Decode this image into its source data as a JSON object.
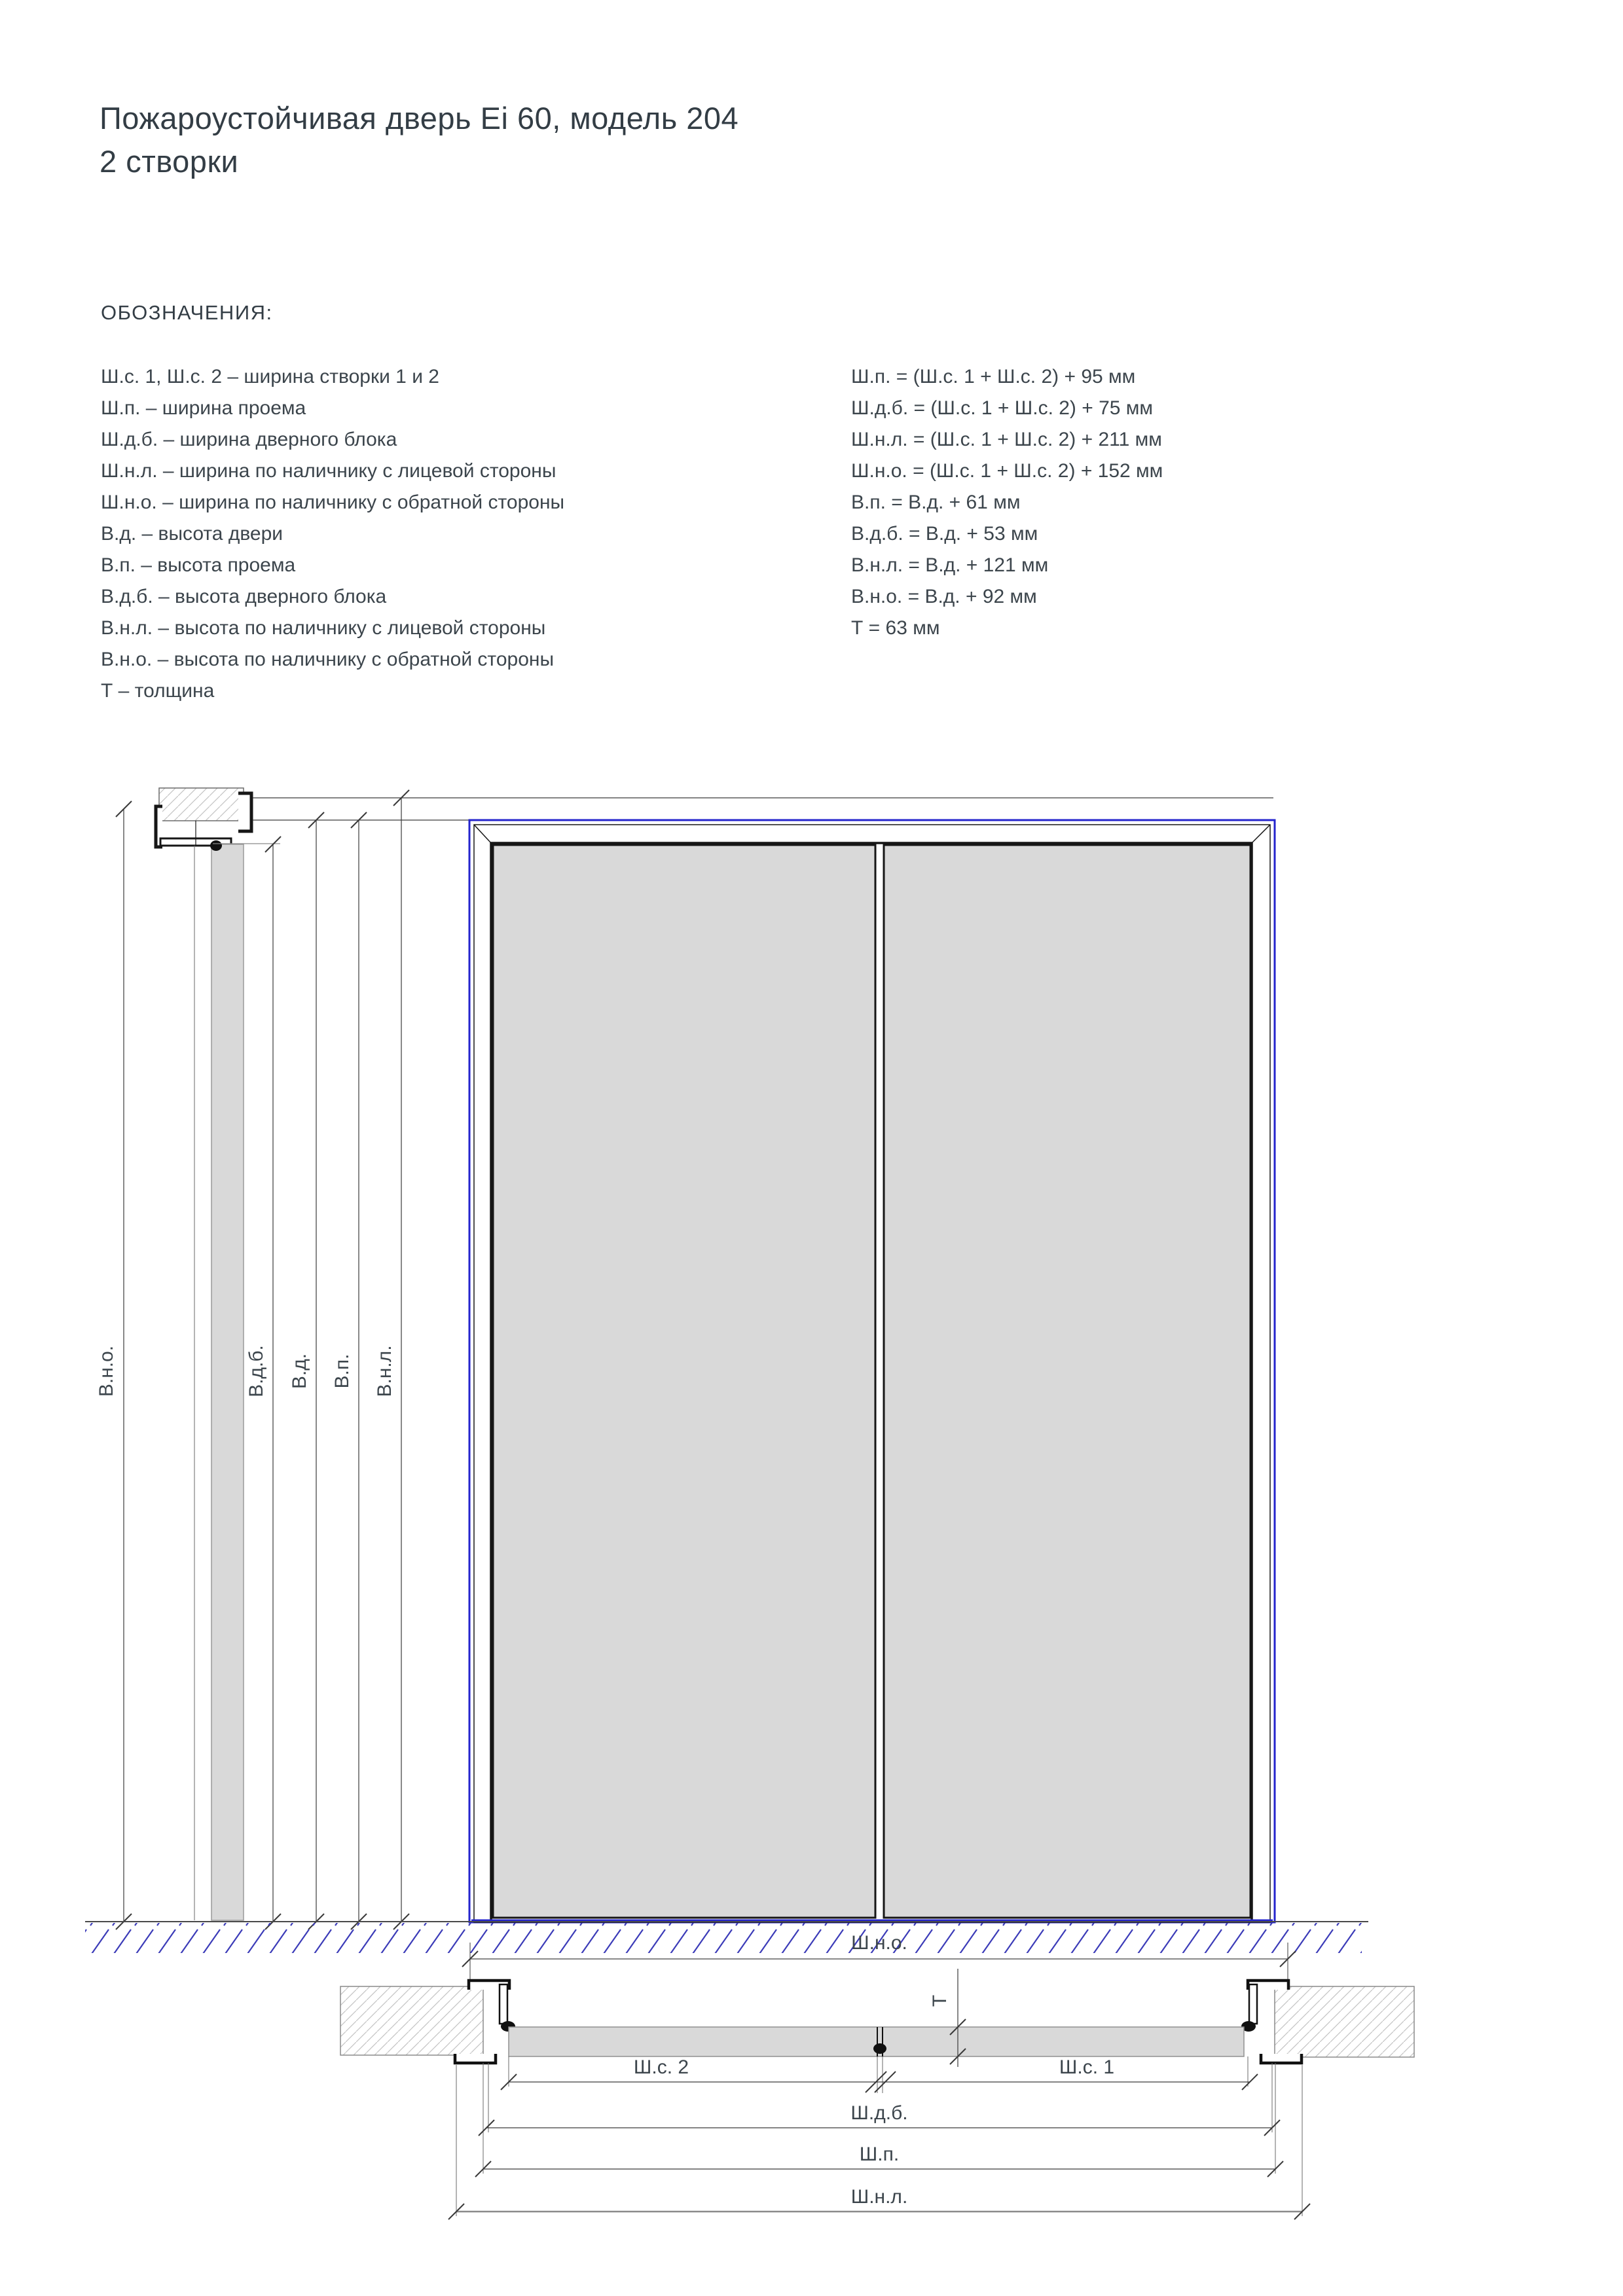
{
  "page": {
    "title_line1": "Пожароустойчивая дверь Ei 60, модель 204",
    "title_line2": "2 створки"
  },
  "legend": {
    "heading": "ОБОЗНАЧЕНИЯ:",
    "left": [
      "Ш.с. 1, Ш.с. 2 – ширина створки 1 и 2",
      "Ш.п. – ширина проема",
      "Ш.д.б. – ширина дверного блока",
      "Ш.н.л. – ширина по наличнику с лицевой стороны",
      "Ш.н.о. – ширина по наличнику с обратной стороны",
      "В.д. – высота двери",
      "В.п. – высота проема",
      "В.д.б. – высота дверного блока",
      "В.н.л. – высота по наличнику с лицевой стороны",
      "В.н.о. – высота по наличнику с обратной стороны",
      "Т – толщина"
    ],
    "right": [
      "Ш.п. = (Ш.с. 1 + Ш.с. 2) + 95 мм",
      "Ш.д.б. = (Ш.с. 1 + Ш.с. 2) + 75 мм",
      "Ш.н.л. = (Ш.с. 1 + Ш.с. 2)  + 211 мм",
      "Ш.н.о. = (Ш.с. 1 + Ш.с. 2) + 152 мм",
      "В.п. = В.д. + 61 мм",
      "В.д.б. = В.д. + 53 мм",
      "В.н.л. = В.д. + 121 мм",
      "В.н.о. = В.д. + 92 мм",
      "Т = 63 мм"
    ]
  },
  "drawing": {
    "vertical_dims": [
      "В.н.о.",
      "В.д.б.",
      "В.д.",
      "В.п.",
      "В.н.л."
    ],
    "plan_dims": {
      "shno": "Ш.н.о.",
      "shs2": "Ш.с. 2",
      "shs1": "Ш.с. 1",
      "shdb": "Ш.д.б.",
      "shp": "Ш.п.",
      "shnl": "Ш.н.л.",
      "t": "Т"
    },
    "colors": {
      "accent_blue": "#2424cd",
      "leaf_gray": "#d9d9d9",
      "line_dark": "#161616",
      "line_gray": "#8a8a8a",
      "text": "#3c454c"
    }
  }
}
